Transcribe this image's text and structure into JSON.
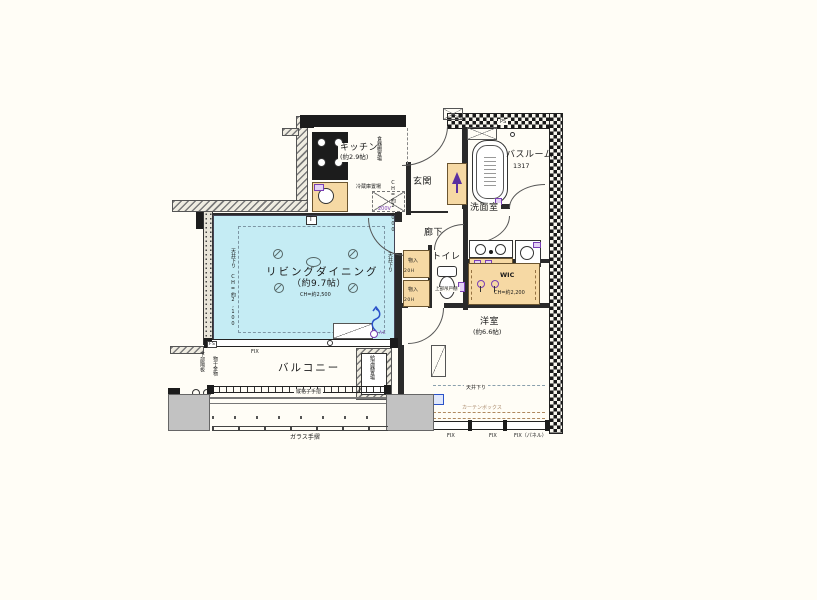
{
  "rooms": {
    "living": {
      "name": "リビングダイニング",
      "size": "（約9.7帖）",
      "ch": "CH=約2,500"
    },
    "kitchen": {
      "name": "キッチン",
      "size": "(約2.9帖)"
    },
    "bedroom": {
      "name": "洋室",
      "size": "(約6.6帖)"
    },
    "bathroom": {
      "name": "バスルーム",
      "size": "1317"
    },
    "washroom": {
      "name": "洗面室"
    },
    "toilet": {
      "name": "トイレ"
    },
    "entrance": {
      "name": "玄関"
    },
    "hallway": {
      "name": "廊下"
    },
    "wic": {
      "name": "WIC",
      "ch": "CH=約2,200"
    },
    "balcony": {
      "name": "バルコニー"
    }
  },
  "annotations": {
    "dish_shelf": "食器棚置場",
    "fridge": "冷蔵庫置場",
    "volt": "200V",
    "kitchen_ch": "CH=約2,000",
    "ps": "PS",
    "storage": "物入",
    "storage_h": "20H",
    "upper_cabinet": "上部吊戸棚",
    "drop_left": "天井下り CH=約2,100",
    "drop_right": "天井下り",
    "drop_bedroom": "天井下り",
    "curtain_box": "カーテンボックス",
    "fix": "FIX",
    "fix_panel": "FIX（パネル）",
    "fs": "FS",
    "lattice_rail": "縦格子手摺",
    "glass_rail": "ガラス手摺",
    "partition": "下部隔板",
    "laundry": "物干金物",
    "heater": "給湯器置場",
    "ac": "AC",
    "t_mark": "T"
  },
  "colors": {
    "living_fill": "#c5ecf4",
    "storage_fill": "#f6d9a4",
    "wall": "#1c1c1c",
    "slab": "#c2c2c2",
    "accent_purple": "#7a3fb5",
    "accent_blue": "#2a52c9",
    "background": "#fffdf6"
  }
}
